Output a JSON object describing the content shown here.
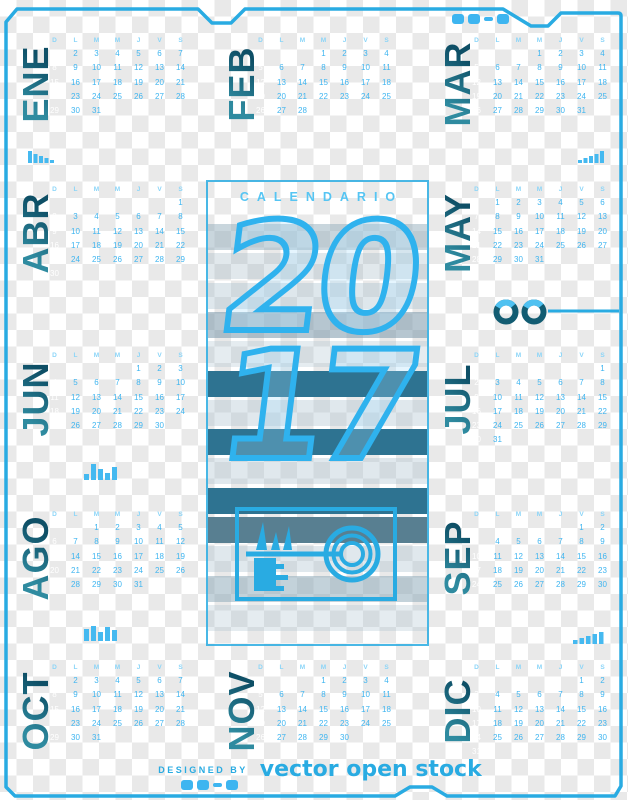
{
  "panel": {
    "title": "CALENDARIO",
    "year_top": "20",
    "year_bottom": "17",
    "stripes": [
      "rgba(148,173,188,0.50)",
      "rgba(148,173,188,0.28)",
      "rgba(168,192,206,0.38)",
      "rgba(122,152,170,0.55)",
      "rgba(168,192,206,0.30)",
      "#2e7391",
      "rgba(168,192,206,0.36)",
      "#2e7391",
      "rgba(168,192,206,0.36)",
      "#2e7391",
      "#587f91",
      "rgba(168,192,206,0.36)",
      "rgba(135,165,182,0.50)",
      "rgba(168,192,206,0.30)"
    ]
  },
  "day_headers": [
    "D",
    "L",
    "M",
    "M",
    "J",
    "V",
    "S"
  ],
  "months": [
    {
      "label": "ENE",
      "start_dow": 0,
      "days": 31,
      "band": 1,
      "col": 1
    },
    {
      "label": "FEB",
      "start_dow": 3,
      "days": 28,
      "band": 1,
      "col": 2
    },
    {
      "label": "MAR",
      "start_dow": 3,
      "days": 31,
      "band": 1,
      "col": 3
    },
    {
      "label": "ABR",
      "start_dow": 6,
      "days": 30,
      "band": 2,
      "col": 1
    },
    {
      "label": "MAY",
      "start_dow": 1,
      "days": 31,
      "band": 2,
      "col": 3
    },
    {
      "label": "JUN",
      "start_dow": 4,
      "days": 30,
      "band": 3,
      "col": 1
    },
    {
      "label": "JUL",
      "start_dow": 6,
      "days": 31,
      "band": 3,
      "col": 3
    },
    {
      "label": "AGO",
      "start_dow": 2,
      "days": 31,
      "band": 4,
      "col": 1
    },
    {
      "label": "SEP",
      "start_dow": 5,
      "days": 30,
      "band": 4,
      "col": 3
    },
    {
      "label": "OCT",
      "start_dow": 0,
      "days": 31,
      "band": 5,
      "col": 1
    },
    {
      "label": "NOV",
      "start_dow": 3,
      "days": 30,
      "band": 5,
      "col": 2
    },
    {
      "label": "DIC",
      "start_dow": 5,
      "days": 31,
      "band": 5,
      "col": 3
    }
  ],
  "footer": {
    "designed_by": "DESIGNED BY",
    "brand": "vector open stock"
  },
  "colors": {
    "accent": "#29abe2",
    "day_number": "#3fb5f0",
    "day_header": "#8bd5f8",
    "sunday_number": "#ffffff",
    "month_label": "#17697e",
    "stripe_teal": "#2e7391"
  },
  "icons": [
    "key-icon",
    "double-rings-icon",
    "equalizer-bars-icon",
    "signal-bars-icon",
    "tech-glyphs-icon",
    "descending-bars-icon"
  ]
}
